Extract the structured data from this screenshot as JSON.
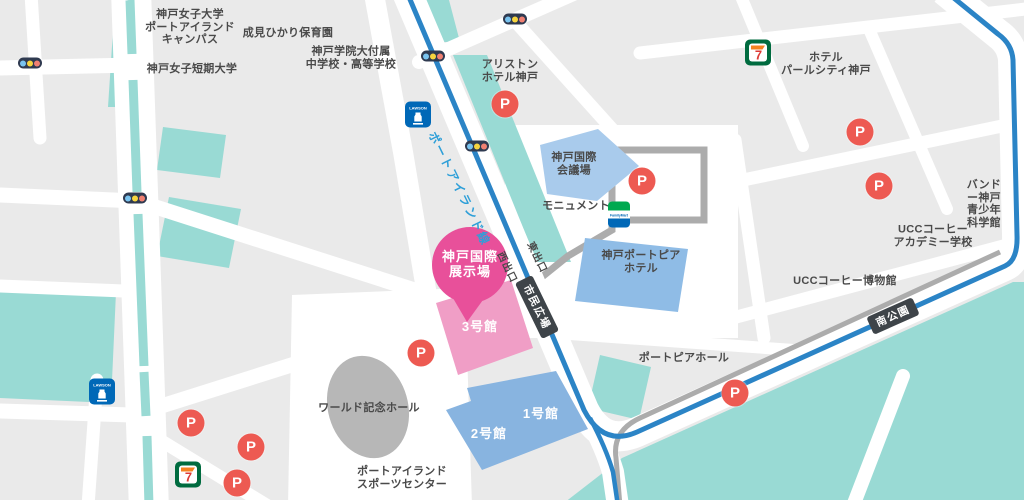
{
  "map": {
    "place_labels": [
      {
        "id": "kobe-womens-university",
        "text": "神戸女子大学\nポートアイランド\nキャンパス"
      },
      {
        "id": "narumi-hikari-nursery",
        "text": "成見ひかり保育園"
      },
      {
        "id": "kobe-gakuin-school",
        "text": "神戸学院大付属\n中学校・高等学校"
      },
      {
        "id": "kobe-womens-junior-college",
        "text": "神戸女子短期大学"
      },
      {
        "id": "ariston-hotel-kobe",
        "text": "アリストン\nホテル神戸"
      },
      {
        "id": "hotel-pearl-city-kobe",
        "text": "ホテル\nパールシティ神戸"
      },
      {
        "id": "bando-kobe-science-museum",
        "text": "バンドー神戸\n青少年科学館"
      },
      {
        "id": "ucc-coffee-academy",
        "text": "UCCコーヒー\nアカデミー学校"
      },
      {
        "id": "ucc-coffee-museum",
        "text": "UCCコーヒー博物館"
      },
      {
        "id": "monument",
        "text": "モニュメント"
      },
      {
        "id": "portopia-hall",
        "text": "ポートピアホール"
      },
      {
        "id": "world-memorial-hall",
        "text": "ワールド記念ホール"
      },
      {
        "id": "port-island-sports-center",
        "text": "ポートアイランド\nスポーツセンター"
      }
    ],
    "buildings": {
      "conference_center": "神戸国際\n会議場",
      "portopia_hotel": "神戸ポートピア\nホテル",
      "hall_1": "1号館",
      "hall_2": "2号館",
      "hall_3": "3号館"
    },
    "callout": {
      "text": "神戸国際\n展示場"
    },
    "transit": {
      "line_name": "ポートアイランド線",
      "station_shimin_hiroba": "市民広場",
      "station_minami_koen": "南公園",
      "exit_east": "東出口",
      "exit_west": "西出口"
    },
    "icons": {
      "parking": "P",
      "seven_eleven": "7",
      "lawson": "LAWSON",
      "familymart": "FamilyMart"
    }
  },
  "colors": {
    "background": "#EAEAEA",
    "road": "#FFFFFF",
    "park_green": "#99DAD4",
    "rail_blue": "#2B84C6",
    "rail_text_blue": "#2E9FD8",
    "route_gray": "#ACACAC",
    "station_badge": "#3E4449",
    "building_blue": "#88B4E0",
    "conference_blue": "#A9CBEC",
    "hall_pink": "#F09EC6",
    "callout_pink": "#E8509A",
    "parking_red": "#ED5A52",
    "stadium_gray": "#B7B7B7",
    "label_dark": "#4A4A4A"
  }
}
